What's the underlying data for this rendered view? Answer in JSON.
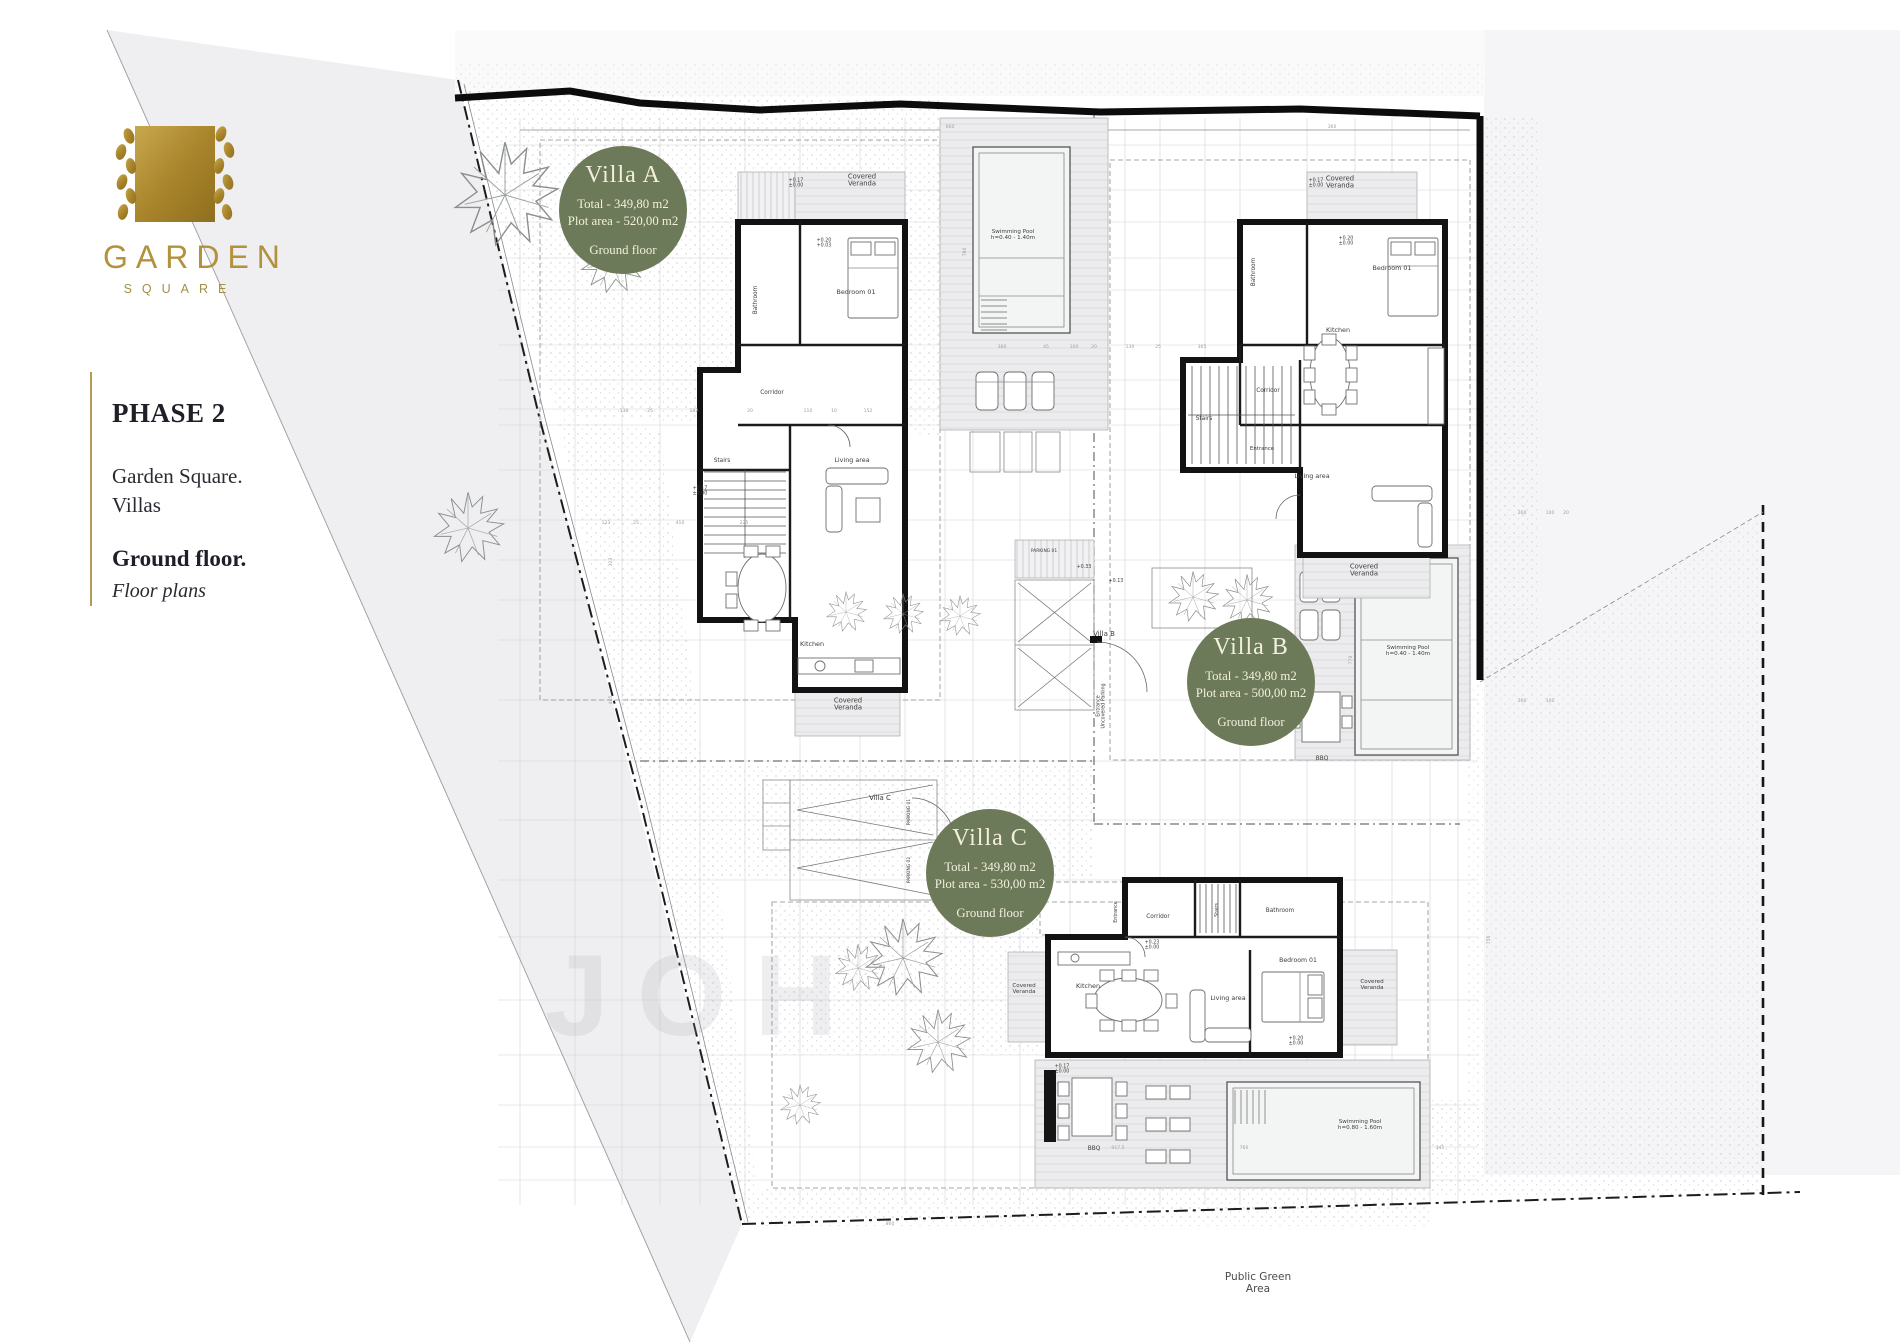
{
  "logo": {
    "brand": "GARDEN",
    "sub": "SQUARE"
  },
  "sidebar": {
    "phase": "PHASE 2",
    "project_line1": "Garden Square.",
    "project_line2": "Villas",
    "floor": "Ground floor.",
    "floor_sub": "Floor plans"
  },
  "colors": {
    "badge": "#6c7a59",
    "badge_text": "#f3efdd",
    "gold": "#b3923d",
    "wall": "#121212"
  },
  "badges": [
    {
      "id": "villa-a",
      "title": "Villa A",
      "total": "Total - 349,80 m2",
      "plot": "Plot area - 520,00 m2",
      "floor": "Ground floor",
      "cx": 623,
      "cy": 210,
      "r": 64
    },
    {
      "id": "villa-b",
      "title": "Villa B",
      "total": "Total - 349,80 m2",
      "plot": "Plot area - 500,00 m2",
      "floor": "Ground floor",
      "cx": 1251,
      "cy": 682,
      "r": 64
    },
    {
      "id": "villa-c",
      "title": "Villa C",
      "total": "Total - 349,80 m2",
      "plot": "Plot area - 530,00 m2",
      "floor": "Ground floor",
      "cx": 990,
      "cy": 873,
      "r": 64
    }
  ],
  "plan": {
    "watermark": "JOH",
    "labels": [
      {
        "t": "Covered\nVeranda",
        "x": 862,
        "y": 182,
        "s": 6.8
      },
      {
        "t": "Bedroom 01",
        "x": 856,
        "y": 294,
        "s": 6.4
      },
      {
        "t": "Bathroom",
        "x": 757,
        "y": 300,
        "r": -90,
        "s": 5.8
      },
      {
        "t": "Corridor",
        "x": 772,
        "y": 394,
        "s": 5.8
      },
      {
        "t": "Stairs",
        "x": 722,
        "y": 462,
        "s": 5.8
      },
      {
        "t": "Living area",
        "x": 852,
        "y": 462,
        "s": 6.4
      },
      {
        "t": "Kitchen",
        "x": 812,
        "y": 646,
        "s": 6.4
      },
      {
        "t": "Covered\nVeranda",
        "x": 848,
        "y": 706,
        "s": 6.8
      },
      {
        "t": "Swimming Pool\nh=0.40 - 1.40m",
        "x": 1013,
        "y": 236,
        "s": 5.6
      },
      {
        "t": "Covered\nVeranda",
        "x": 1340,
        "y": 184,
        "s": 6.8
      },
      {
        "t": "Bedroom 01",
        "x": 1392,
        "y": 270,
        "s": 6.4
      },
      {
        "t": "Bathroom",
        "x": 1255,
        "y": 272,
        "r": -90,
        "s": 5.8
      },
      {
        "t": "Stairs",
        "x": 1204,
        "y": 420,
        "s": 5.8
      },
      {
        "t": "Kitchen",
        "x": 1338,
        "y": 332,
        "s": 6.4
      },
      {
        "t": "Corridor",
        "x": 1268,
        "y": 392,
        "s": 5.8
      },
      {
        "t": "Entrance",
        "x": 1262,
        "y": 450,
        "s": 5.4
      },
      {
        "t": "Living area",
        "x": 1312,
        "y": 478,
        "s": 6.4
      },
      {
        "t": "Covered\nVeranda",
        "x": 1364,
        "y": 572,
        "s": 6.8
      },
      {
        "t": "Swimming Pool\nh=0.40 - 1.40m",
        "x": 1408,
        "y": 652,
        "s": 5.6
      },
      {
        "t": "BBQ",
        "x": 1322,
        "y": 760,
        "s": 5.8
      },
      {
        "t": "Villa B",
        "x": 1104,
        "y": 636,
        "s": 7
      },
      {
        "t": "PARKING 01",
        "x": 1044,
        "y": 552,
        "s": 4.4
      },
      {
        "t": "Entrance\nUncovered Parking",
        "x": 1102,
        "y": 706,
        "r": -90,
        "s": 4.8
      },
      {
        "t": "Villa C",
        "x": 880,
        "y": 800,
        "s": 7
      },
      {
        "t": "PARKING 01",
        "x": 910,
        "y": 812,
        "r": -90,
        "s": 4.4
      },
      {
        "t": "PARKING 02",
        "x": 910,
        "y": 870,
        "r": -90,
        "s": 4.4
      },
      {
        "t": "Corridor",
        "x": 1158,
        "y": 918,
        "s": 5.8
      },
      {
        "t": "Stairs",
        "x": 1218,
        "y": 910,
        "r": -90,
        "s": 4.8
      },
      {
        "t": "Bathroom",
        "x": 1280,
        "y": 912,
        "s": 5.8
      },
      {
        "t": "Bedroom 01",
        "x": 1298,
        "y": 962,
        "s": 6.2
      },
      {
        "t": "Kitchen",
        "x": 1088,
        "y": 988,
        "s": 6.4
      },
      {
        "t": "Living area",
        "x": 1228,
        "y": 1000,
        "s": 6.4
      },
      {
        "t": "Entrance",
        "x": 1117,
        "y": 912,
        "r": -90,
        "s": 4.8
      },
      {
        "t": "Covered\nVeranda",
        "x": 1024,
        "y": 990,
        "s": 5.6
      },
      {
        "t": "Covered\nVeranda",
        "x": 1372,
        "y": 986,
        "s": 5.6
      },
      {
        "t": "BBQ",
        "x": 1094,
        "y": 1150,
        "s": 5.8
      },
      {
        "t": "Swimming Pool\nh=0.80 - 1.60m",
        "x": 1360,
        "y": 1126,
        "s": 5.6
      },
      {
        "t": "+0.17\n±0.00",
        "x": 796,
        "y": 184,
        "s": 4.8
      },
      {
        "t": "+0.20\n+0.03",
        "x": 824,
        "y": 244,
        "s": 4.8
      },
      {
        "t": "+0.17\n±0.00",
        "x": 1316,
        "y": 184,
        "s": 4.8
      },
      {
        "t": "+0.20\n±0.00",
        "x": 1346,
        "y": 242,
        "s": 4.8
      },
      {
        "t": "+0.17\n±0.00",
        "x": 700,
        "y": 492,
        "s": 4.8
      },
      {
        "t": "+0.23\n±0.00",
        "x": 1152,
        "y": 946,
        "s": 4.8
      },
      {
        "t": "+0.20\n±0.00",
        "x": 1296,
        "y": 1042,
        "s": 4.8
      },
      {
        "t": "+0.17\n±0.00",
        "x": 1062,
        "y": 1070,
        "s": 4.8
      },
      {
        "t": "+0.33",
        "x": 1084,
        "y": 568,
        "s": 4.8
      },
      {
        "t": "+0.13",
        "x": 1116,
        "y": 582,
        "s": 4.8
      },
      {
        "t": "Public Green\nArea",
        "x": 1258,
        "y": 1286,
        "s": 10.5,
        "c": "pub"
      }
    ],
    "dimensions": [
      {
        "t": "130",
        "x": 624,
        "y": 412
      },
      {
        "t": "25",
        "x": 650,
        "y": 412
      },
      {
        "t": "182",
        "x": 694,
        "y": 412
      },
      {
        "t": "20",
        "x": 750,
        "y": 412
      },
      {
        "t": "110",
        "x": 808,
        "y": 412
      },
      {
        "t": "10",
        "x": 834,
        "y": 412
      },
      {
        "t": "152",
        "x": 868,
        "y": 412
      },
      {
        "t": "123",
        "x": 606,
        "y": 524
      },
      {
        "t": "25",
        "x": 636,
        "y": 524
      },
      {
        "t": "410",
        "x": 680,
        "y": 524
      },
      {
        "t": "225",
        "x": 744,
        "y": 524
      },
      {
        "t": "360",
        "x": 1002,
        "y": 348
      },
      {
        "t": "45",
        "x": 1046,
        "y": 348
      },
      {
        "t": "100",
        "x": 1074,
        "y": 348
      },
      {
        "t": "20",
        "x": 1094,
        "y": 348
      },
      {
        "t": "130",
        "x": 1130,
        "y": 348
      },
      {
        "t": "25",
        "x": 1158,
        "y": 348
      },
      {
        "t": "365",
        "x": 1202,
        "y": 348
      },
      {
        "t": "660",
        "x": 950,
        "y": 128
      },
      {
        "t": "360",
        "x": 1332,
        "y": 128
      },
      {
        "t": "780",
        "x": 966,
        "y": 252,
        "r": -90
      },
      {
        "t": "770",
        "x": 1352,
        "y": 660,
        "r": -90
      },
      {
        "t": "917.5",
        "x": 1118,
        "y": 1149
      },
      {
        "t": "760",
        "x": 1244,
        "y": 1149
      },
      {
        "t": "341",
        "x": 1440,
        "y": 1149
      },
      {
        "t": "260",
        "x": 1522,
        "y": 514
      },
      {
        "t": "100",
        "x": 1550,
        "y": 514
      },
      {
        "t": "20",
        "x": 1566,
        "y": 514
      },
      {
        "t": "260",
        "x": 1522,
        "y": 702
      },
      {
        "t": "100",
        "x": 1550,
        "y": 702
      },
      {
        "t": "445",
        "x": 612,
        "y": 700,
        "r": -90
      },
      {
        "t": "323",
        "x": 612,
        "y": 562,
        "r": -90
      },
      {
        "t": "750",
        "x": 1490,
        "y": 940,
        "r": -90
      },
      {
        "t": "150",
        "x": 1028,
        "y": 840
      },
      {
        "t": "860",
        "x": 890,
        "y": 1225
      }
    ],
    "trees": [
      {
        "x": 505,
        "y": 195,
        "s": 1.55
      },
      {
        "x": 612,
        "y": 262,
        "s": 0.95
      },
      {
        "x": 468,
        "y": 528,
        "s": 1.05
      },
      {
        "x": 846,
        "y": 612,
        "s": 0.6
      },
      {
        "x": 903,
        "y": 614,
        "s": 0.6
      },
      {
        "x": 960,
        "y": 616,
        "s": 0.6
      },
      {
        "x": 1193,
        "y": 597,
        "s": 0.75
      },
      {
        "x": 1247,
        "y": 600,
        "s": 0.75
      },
      {
        "x": 903,
        "y": 958,
        "s": 1.15
      },
      {
        "x": 858,
        "y": 968,
        "s": 0.7
      },
      {
        "x": 938,
        "y": 1042,
        "s": 0.95
      },
      {
        "x": 800,
        "y": 1105,
        "s": 0.6
      }
    ],
    "public_green": "Public Green Area"
  }
}
